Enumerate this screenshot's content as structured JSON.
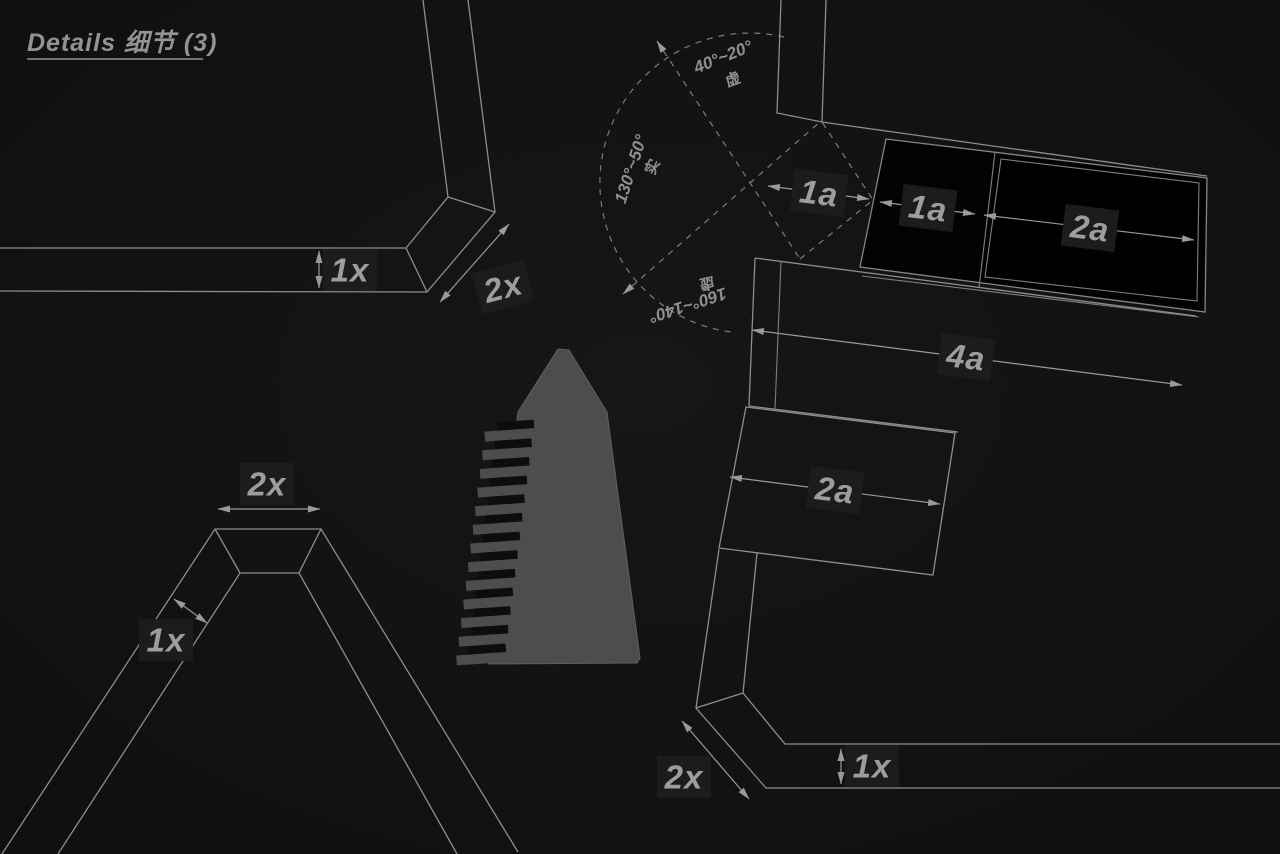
{
  "title": {
    "text": "Details 细节 (3)"
  },
  "colors": {
    "background": "#131313",
    "line": "#8d8d8d",
    "dashed_line": "#7c7c7c",
    "label": "#9d9d9d",
    "label_halo": "#1c1c1c",
    "panel_fill": "#030303",
    "monolith_fill": "#4d4d4d",
    "monolith_step_slot": "#0d0d0d",
    "title_color": "#939393"
  },
  "labels": {
    "top_left_band_width": "1x",
    "top_left_band_bevel": "2x",
    "a_frame_top": "2x",
    "a_frame_leg_width": "1x",
    "panel_gap": "1a",
    "panel_left": "1a",
    "panel_right": "2a",
    "panel_total": "4a",
    "block_width": "2a",
    "bottom_band_width": "1x",
    "bottom_band_bevel": "2x"
  },
  "angles": {
    "top": {
      "range": "40°~20°",
      "style": "虚"
    },
    "left": {
      "range": "130°~50°",
      "style": "实"
    },
    "bottom": {
      "range": "160°~140°",
      "style": "虚"
    }
  }
}
